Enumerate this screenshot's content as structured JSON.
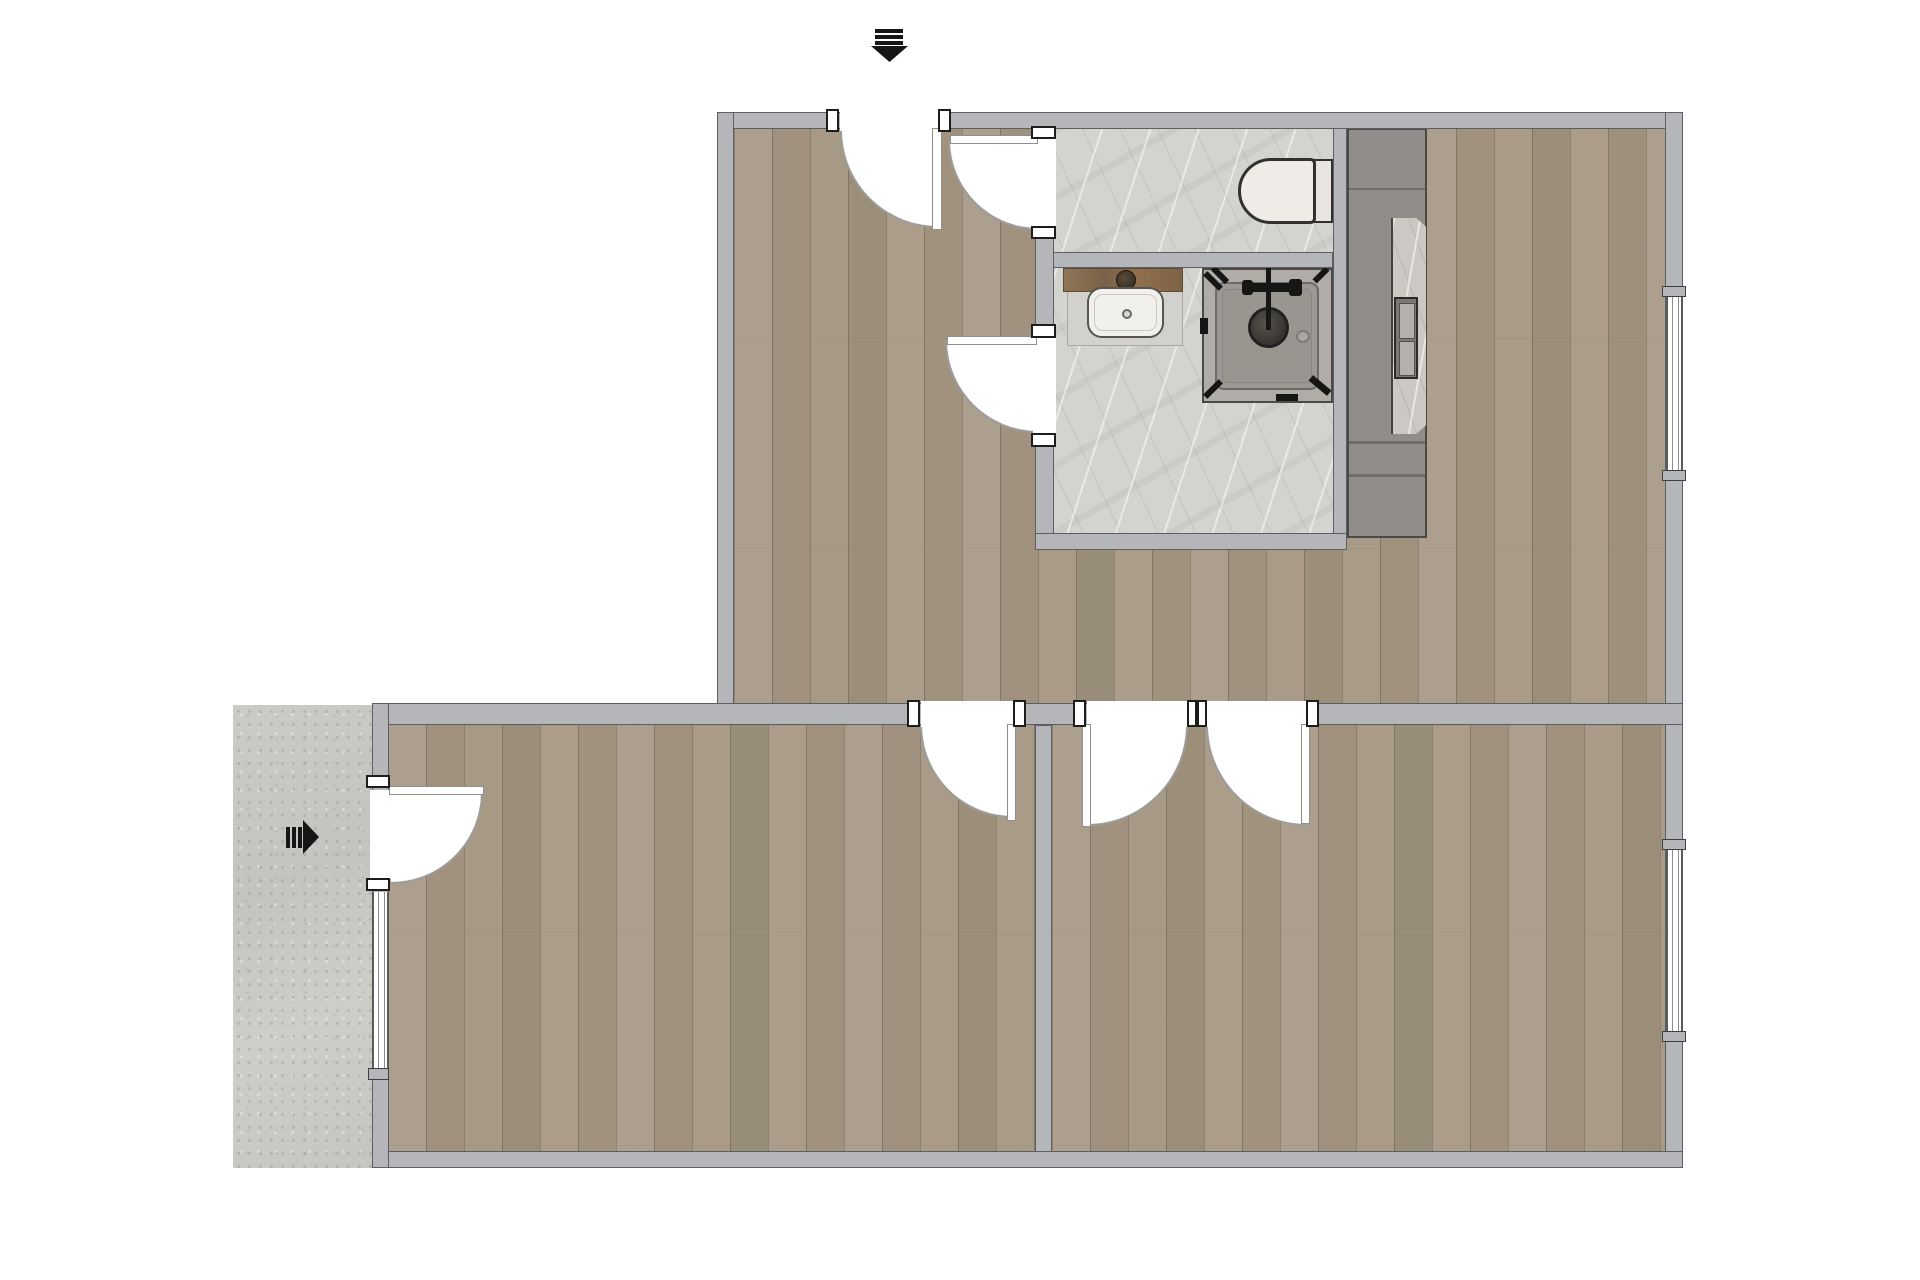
{
  "document": {
    "type": "apartment-floor-plan",
    "background": "#ffffff",
    "canvas": {
      "width": 1920,
      "height": 1280
    }
  },
  "colors": {
    "wall": "#b4b6ba",
    "wall_outline": "#5c5e63",
    "wood_base": "#a79884",
    "marble_base": "#d3d4d0",
    "concrete_base": "#c8c8c5",
    "counter": "#908d8a",
    "counter_recess": "#ccc9c2",
    "fixture_white": "#efece7",
    "fixture_outline": "#323130",
    "shower_tray": "#9c9994",
    "black": "#161614",
    "arc_line": "#9c9c9a"
  },
  "markers": {
    "top_entrance_arrow": {
      "style": "triple-bar-arrow",
      "direction": "down"
    },
    "left_entrance_arrow": {
      "style": "triple-bar-arrow",
      "direction": "right"
    }
  },
  "rooms": [
    {
      "name": "hallway-living-area",
      "floor": "wood"
    },
    {
      "name": "wc",
      "floor": "marble",
      "fixtures": [
        "toilet"
      ]
    },
    {
      "name": "bathroom",
      "floor": "marble",
      "fixtures": [
        "washbasin",
        "shower"
      ]
    },
    {
      "name": "kitchen-area",
      "floor": "wood",
      "fixtures": [
        "kitchen-counter",
        "sink-cooktop-unit"
      ]
    },
    {
      "name": "room-bottom-left",
      "floor": "wood"
    },
    {
      "name": "room-bottom-right",
      "floor": "wood"
    },
    {
      "name": "patio",
      "floor": "concrete"
    }
  ],
  "openings": {
    "doors": [
      {
        "name": "main-entrance-door",
        "location": "top-wall"
      },
      {
        "name": "wc-door",
        "location": "bathroom-left-wall"
      },
      {
        "name": "bathroom-door",
        "location": "bathroom-left-wall"
      },
      {
        "name": "room-bottom-left-door",
        "location": "middle-wall"
      },
      {
        "name": "room-bottom-right-door-a",
        "location": "middle-wall"
      },
      {
        "name": "room-bottom-right-door-b",
        "location": "middle-wall"
      },
      {
        "name": "side-entrance-door",
        "location": "left-wall"
      }
    ],
    "windows": [
      {
        "name": "left-window"
      },
      {
        "name": "right-window-upper"
      },
      {
        "name": "right-window-lower"
      }
    ]
  }
}
